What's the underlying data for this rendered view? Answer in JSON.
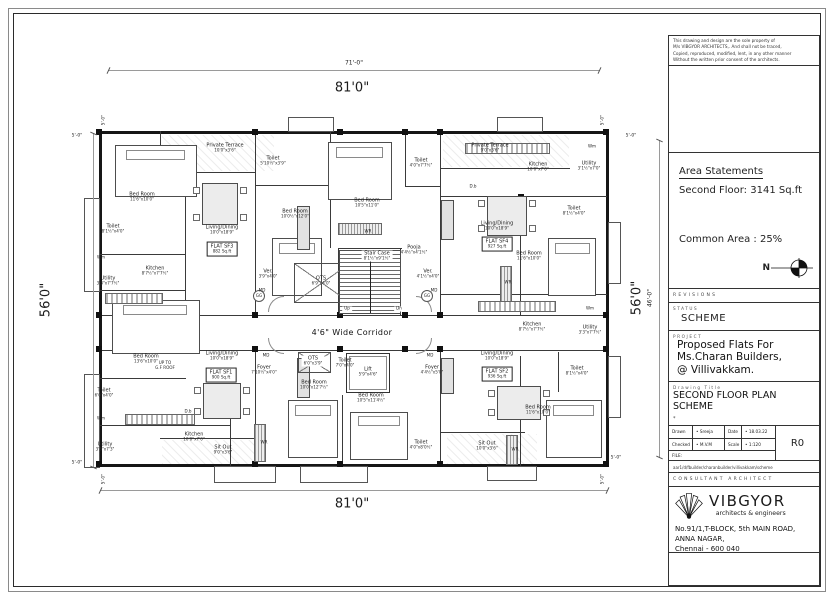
{
  "title_block": {
    "disclaimer_lines": [
      "This drawing and design are the sole property of",
      "M/s VIBGYOR ARCHITECTS,.  And shall not be traced,",
      "Copied, reproduced, modified, lent, in any other manner",
      "Without the written prior consent of the architects."
    ],
    "area_statements": {
      "heading": "Area Statements",
      "second_floor": "Second Floor: 3141 Sq.ft",
      "common_area": "Common Area : 25%",
      "north_label": "N"
    },
    "revisions_label": "REVISIONS",
    "status_label": "STATUS",
    "status_value": "SCHEME",
    "project_label": "PROJECT",
    "project_lines": [
      "Proposed Flats For",
      "Ms.Charan Builders,",
      "@ Villivakkam."
    ],
    "drawing_title_label": "Drawing Title",
    "drawing_title_lines": [
      "SECOND FLOOR PLAN",
      "SCHEME"
    ],
    "note_mark": "*",
    "table": {
      "drawn_label": "Drawn",
      "drawn_value": "Sreeja",
      "date_label": "Date",
      "date_value": "18.03.22",
      "checked_label": "Checked",
      "checked_value": "M.V.M",
      "scale_label": "Scale",
      "scale_value": "1:120",
      "revision": "R0",
      "file_label": "FILE:",
      "file_path": "aar1/d/fbuilder/charanbuilder/villivakkam/scheme"
    },
    "consultant_label": "CONSULTANT ARCHITECT",
    "firm": {
      "name": "VIBGYOR",
      "tagline": "architects & engineers",
      "address_lines": [
        "No.91/1,T-BLOCK, 5th MAIN ROAD,",
        "ANNA NAGAR,",
        "Chennai - 600 040"
      ]
    }
  },
  "plan": {
    "outer_walls": [
      [
        99,
        131,
        510,
        3
      ],
      [
        99,
        464,
        510,
        3
      ],
      [
        99,
        131,
        3,
        336
      ],
      [
        606,
        131,
        3,
        336
      ]
    ],
    "inner_walls": [
      [
        99,
        315,
        510,
        1.3
      ],
      [
        99,
        350,
        510,
        1.3
      ],
      [
        255,
        131,
        1.3,
        185
      ],
      [
        440,
        131,
        1.3,
        185
      ],
      [
        330,
        131,
        1.3,
        117
      ],
      [
        185,
        172,
        1.3,
        144
      ],
      [
        160,
        131,
        1.3,
        42
      ],
      [
        160,
        172,
        96,
        1.3
      ],
      [
        440,
        168,
        130,
        1.3
      ],
      [
        99,
        254,
        87,
        1.3
      ],
      [
        99,
        290,
        87,
        1.3
      ],
      [
        405,
        131,
        1.3,
        56
      ],
      [
        405,
        186,
        36,
        1.3
      ],
      [
        255,
        185,
        76,
        1.3
      ],
      [
        440,
        196,
        167,
        1.3
      ],
      [
        520,
        196,
        1.3,
        120
      ],
      [
        99,
        378,
        87,
        1.3
      ],
      [
        99,
        425,
        131,
        1.3
      ],
      [
        230,
        415,
        1.3,
        52
      ],
      [
        255,
        350,
        1.3,
        117
      ],
      [
        440,
        350,
        1.3,
        117
      ],
      [
        342,
        395,
        1.3,
        70
      ],
      [
        520,
        356,
        1.3,
        111
      ],
      [
        440,
        294,
        167,
        1.3
      ],
      [
        558,
        352,
        1.3,
        40
      ],
      [
        440,
        432,
        85,
        1.3
      ],
      [
        160,
        438,
        95,
        1.3
      ],
      [
        338,
        248,
        64,
        1.3
      ],
      [
        338,
        248,
        1.3,
        68
      ],
      [
        400,
        248,
        1.3,
        68
      ]
    ],
    "bumps": [
      [
        288,
        117,
        46,
        15
      ],
      [
        497,
        117,
        46,
        15
      ],
      [
        214,
        466,
        62,
        17
      ],
      [
        300,
        466,
        68,
        17
      ],
      [
        487,
        466,
        50,
        15
      ],
      [
        84,
        198,
        16,
        94
      ],
      [
        84,
        374,
        16,
        94
      ],
      [
        608,
        222,
        13,
        62
      ],
      [
        608,
        356,
        13,
        62
      ]
    ],
    "columns": [
      [
        96,
        129
      ],
      [
        252,
        129
      ],
      [
        337,
        129
      ],
      [
        402,
        129
      ],
      [
        437,
        129
      ],
      [
        603,
        129
      ],
      [
        96,
        312
      ],
      [
        252,
        312
      ],
      [
        337,
        312
      ],
      [
        402,
        312
      ],
      [
        437,
        312
      ],
      [
        603,
        312
      ],
      [
        96,
        346
      ],
      [
        252,
        346
      ],
      [
        337,
        346
      ],
      [
        402,
        346
      ],
      [
        437,
        346
      ],
      [
        603,
        346
      ],
      [
        96,
        461
      ],
      [
        252,
        461
      ],
      [
        337,
        461
      ],
      [
        437,
        461
      ],
      [
        603,
        461
      ],
      [
        182,
        170
      ],
      [
        518,
        194
      ]
    ],
    "dimlines": [
      [
        108,
        70,
        492,
        1
      ],
      [
        93,
        133,
        1,
        335
      ],
      [
        659,
        140,
        1,
        318
      ],
      [
        100,
        490,
        508,
        1
      ]
    ],
    "furniture": [
      {
        "t": "hatch",
        "x": 162,
        "y": 135,
        "w": 112,
        "h": 36
      },
      {
        "t": "hatch",
        "x": 443,
        "y": 135,
        "w": 126,
        "h": 32
      },
      {
        "t": "hatch",
        "x": 162,
        "y": 440,
        "w": 92,
        "h": 24
      },
      {
        "t": "hatch",
        "x": 447,
        "y": 434,
        "w": 90,
        "h": 30
      },
      {
        "t": "bed",
        "x": 115,
        "y": 145,
        "w": 82,
        "h": 52
      },
      {
        "t": "bed",
        "x": 328,
        "y": 142,
        "w": 64,
        "h": 58
      },
      {
        "t": "bed",
        "x": 548,
        "y": 238,
        "w": 48,
        "h": 58
      },
      {
        "t": "bed",
        "x": 112,
        "y": 300,
        "w": 88,
        "h": 54
      },
      {
        "t": "bed",
        "x": 288,
        "y": 400,
        "w": 50,
        "h": 58
      },
      {
        "t": "bed",
        "x": 350,
        "y": 412,
        "w": 58,
        "h": 48
      },
      {
        "t": "bed",
        "x": 546,
        "y": 400,
        "w": 56,
        "h": 58
      },
      {
        "t": "bed",
        "x": 272,
        "y": 238,
        "w": 50,
        "h": 58
      },
      {
        "t": "table",
        "x": 202,
        "y": 183,
        "w": 36,
        "h": 42
      },
      {
        "t": "table",
        "x": 203,
        "y": 383,
        "w": 38,
        "h": 36
      },
      {
        "t": "table",
        "x": 487,
        "y": 196,
        "w": 40,
        "h": 40
      },
      {
        "t": "table",
        "x": 497,
        "y": 386,
        "w": 44,
        "h": 34
      },
      {
        "t": "sofa",
        "x": 297,
        "y": 206,
        "w": 13,
        "h": 44
      },
      {
        "t": "sofa",
        "x": 297,
        "y": 358,
        "w": 13,
        "h": 40
      },
      {
        "t": "sofa",
        "x": 441,
        "y": 200,
        "w": 13,
        "h": 40
      },
      {
        "t": "sofa",
        "x": 441,
        "y": 358,
        "w": 13,
        "h": 36
      },
      {
        "t": "counter",
        "x": 105,
        "y": 293,
        "w": 58,
        "h": 11
      },
      {
        "t": "counter",
        "x": 125,
        "y": 414,
        "w": 70,
        "h": 11
      },
      {
        "t": "counter",
        "x": 465,
        "y": 143,
        "w": 85,
        "h": 11
      },
      {
        "t": "counter",
        "x": 478,
        "y": 301,
        "w": 78,
        "h": 11
      },
      {
        "t": "strip",
        "x": 338,
        "y": 223,
        "w": 44,
        "h": 12
      },
      {
        "t": "strip",
        "x": 254,
        "y": 424,
        "w": 12,
        "h": 38
      },
      {
        "t": "strip",
        "x": 500,
        "y": 266,
        "w": 12,
        "h": 36
      },
      {
        "t": "strip",
        "x": 506,
        "y": 435,
        "w": 12,
        "h": 30
      },
      {
        "t": "ots",
        "x": 294,
        "y": 263,
        "w": 56,
        "h": 40
      },
      {
        "t": "ots",
        "x": 298,
        "y": 352,
        "w": 33,
        "h": 21
      },
      {
        "t": "stairs",
        "x": 339,
        "y": 250,
        "w": 62,
        "h": 64
      },
      {
        "t": "shaft",
        "x": 346,
        "y": 353,
        "w": 44,
        "h": 40
      },
      {
        "t": "arc",
        "x": 268,
        "y": 296,
        "w": 16,
        "h": 16,
        "r": 0
      },
      {
        "t": "arc",
        "x": 416,
        "y": 296,
        "w": 16,
        "h": 16,
        "r": 90
      },
      {
        "t": "arc",
        "x": 268,
        "y": 338,
        "w": 16,
        "h": 16,
        "r": 270
      },
      {
        "t": "arc",
        "x": 416,
        "y": 338,
        "w": 16,
        "h": 16,
        "r": 180
      }
    ],
    "rooms": [
      {
        "l": "Bed Room",
        "s": "11'6\"x10'0\"",
        "x": 142,
        "y": 197
      },
      {
        "l": "Private Terrace",
        "s": "10'0\"x3'6\"",
        "x": 225,
        "y": 148
      },
      {
        "l": "Toilet",
        "s": "8'1½\"x4'0\"",
        "x": 113,
        "y": 229
      },
      {
        "l": "Living/Dining",
        "s": "10'0\"x18'9\"",
        "x": 222,
        "y": 230
      },
      {
        "l": "FLAT SF3",
        "s": "882 Sq.ft",
        "x": 222,
        "y": 249,
        "c": "box"
      },
      {
        "l": "Kitchen",
        "s": "8'7½\"x7'7½\"",
        "x": 155,
        "y": 271
      },
      {
        "l": "Utility",
        "s": "3'3\"x7'7½\"",
        "x": 108,
        "y": 281
      },
      {
        "l": "Wm",
        "x": 101,
        "y": 258,
        "c": "tiny"
      },
      {
        "l": "Toilet",
        "s": "5'10½\"x3'9\"",
        "x": 273,
        "y": 161
      },
      {
        "l": "Bed Room",
        "s": "10'0½\"x12'0\"",
        "x": 295,
        "y": 214
      },
      {
        "l": "Bed Room",
        "s": "10'5\"x11'0\"",
        "x": 367,
        "y": 203
      },
      {
        "l": "Toilet",
        "s": "4'0\"x7'7½\"",
        "x": 421,
        "y": 163
      },
      {
        "l": "WR",
        "x": 368,
        "y": 232,
        "c": "tiny"
      },
      {
        "l": "Stair Case",
        "s": "8'1½\"x9'1½\"",
        "x": 377,
        "y": 256,
        "c": "onwhite"
      },
      {
        "l": "Pooja",
        "s": "4'4½\"x4'1½\"",
        "x": 414,
        "y": 250
      },
      {
        "l": "Ver.",
        "s": "3'9\"x4'0\"",
        "x": 268,
        "y": 274
      },
      {
        "l": "OTS",
        "s": "6'9\"x4'0\"",
        "x": 321,
        "y": 281
      },
      {
        "l": "Ver.",
        "s": "4'1½\"x4'0\"",
        "x": 428,
        "y": 274
      },
      {
        "l": "GG",
        "x": 259,
        "y": 296,
        "c": "circle"
      },
      {
        "l": "GG",
        "x": 427,
        "y": 296,
        "c": "circle"
      },
      {
        "l": "Up",
        "x": 347,
        "y": 309,
        "c": "tiny onwhite"
      },
      {
        "l": "Dn",
        "x": 399,
        "y": 309,
        "c": "tiny onwhite"
      },
      {
        "l": "4'6\" Wide Corridor",
        "x": 352,
        "y": 333,
        "c": "corridor"
      },
      {
        "l": "MD",
        "x": 262,
        "y": 291,
        "c": "tiny"
      },
      {
        "l": "MD",
        "x": 434,
        "y": 291,
        "c": "tiny"
      },
      {
        "l": "MD",
        "x": 266,
        "y": 356,
        "c": "tiny"
      },
      {
        "l": "MD",
        "x": 430,
        "y": 356,
        "c": "tiny"
      },
      {
        "l": "OTS",
        "s": "6'0\"x3'9\"",
        "x": 313,
        "y": 361,
        "c": "onwhite"
      },
      {
        "l": "Toilet",
        "s": "7'0\"x4'0\"",
        "x": 345,
        "y": 363
      },
      {
        "l": "Lift",
        "s": "5'9\"x4'6\"",
        "x": 368,
        "y": 372,
        "c": "onwhite"
      },
      {
        "l": "Foyer",
        "s": "7'10½\"x4'0\"",
        "x": 264,
        "y": 370
      },
      {
        "l": "Foyer",
        "s": "4'4½\"x5'0\"",
        "x": 432,
        "y": 370
      },
      {
        "l": "Bed Room",
        "s": "13'6\"x10'0\"",
        "x": 146,
        "y": 359
      },
      {
        "l": "UP TO",
        "s": "G.F ROOF",
        "x": 165,
        "y": 366,
        "c": "tiny"
      },
      {
        "l": "Living/Dining",
        "s": "10'0\"x18'9\"",
        "x": 222,
        "y": 356
      },
      {
        "l": "FLAT SF1",
        "s": "900 Sq.ft",
        "x": 221,
        "y": 375,
        "c": "box"
      },
      {
        "l": "Toilet",
        "s": "6'0\"x4'0\"",
        "x": 104,
        "y": 393
      },
      {
        "l": "Wm",
        "x": 101,
        "y": 419,
        "c": "tiny"
      },
      {
        "l": "Utility",
        "s": "3'3\"x7'3\"",
        "x": 105,
        "y": 447
      },
      {
        "l": "Kitchen",
        "s": "10'0\"x7'0\"",
        "x": 194,
        "y": 437
      },
      {
        "l": "D.b",
        "x": 188,
        "y": 412,
        "c": "tiny"
      },
      {
        "l": "Sit Out",
        "s": "9'0\"x3'6\"",
        "x": 223,
        "y": 450
      },
      {
        "l": "WR",
        "x": 264,
        "y": 443,
        "c": "tiny"
      },
      {
        "l": "Bed Room",
        "s": "10'0\"x12'7½\"",
        "x": 314,
        "y": 385
      },
      {
        "l": "Bed Room",
        "s": "10'5\"x11'4½\"",
        "x": 371,
        "y": 398
      },
      {
        "l": "Toilet",
        "s": "4'0\"x8'0½\"",
        "x": 421,
        "y": 445
      },
      {
        "l": "Private Terrace",
        "s": "9'0\"x3'6\"",
        "x": 490,
        "y": 148
      },
      {
        "l": "Kitchen",
        "s": "10'0\"x7'0\"",
        "x": 538,
        "y": 167
      },
      {
        "l": "Utility",
        "s": "3'1½\"x7'0\"",
        "x": 589,
        "y": 166
      },
      {
        "l": "Wm",
        "x": 592,
        "y": 147,
        "c": "tiny"
      },
      {
        "l": "D.b",
        "x": 473,
        "y": 187,
        "c": "tiny"
      },
      {
        "l": "Toilet",
        "s": "8'1½\"x4'0\"",
        "x": 574,
        "y": 211
      },
      {
        "l": "Living/Dining",
        "s": "10'0\"x18'9\"",
        "x": 497,
        "y": 226
      },
      {
        "l": "FLAT SF4",
        "s": "927 Sq.ft",
        "x": 497,
        "y": 244,
        "c": "box"
      },
      {
        "l": "Bed Room",
        "s": "11'6\"x10'0\"",
        "x": 529,
        "y": 256
      },
      {
        "l": "WR",
        "x": 508,
        "y": 283,
        "c": "tiny"
      },
      {
        "l": "Kitchen",
        "s": "8'7½\"x7'7½\"",
        "x": 532,
        "y": 327
      },
      {
        "l": "Utility",
        "s": "3'3\"x7'7½\"",
        "x": 590,
        "y": 330
      },
      {
        "l": "Wm",
        "x": 590,
        "y": 309,
        "c": "tiny"
      },
      {
        "l": "Living/Dining",
        "s": "10'0\"x18'9\"",
        "x": 497,
        "y": 356
      },
      {
        "l": "FLAT SF2",
        "s": "936 Sq.ft",
        "x": 497,
        "y": 374,
        "c": "box"
      },
      {
        "l": "Toilet",
        "s": "8'1½\"x4'0\"",
        "x": 577,
        "y": 371
      },
      {
        "l": "Bed Room",
        "s": "11'6\"x10'0\"",
        "x": 538,
        "y": 410
      },
      {
        "l": "WR",
        "x": 515,
        "y": 450,
        "c": "tiny"
      },
      {
        "l": "Sit Out",
        "s": "10'0\"x3'6\"",
        "x": 487,
        "y": 446
      }
    ],
    "dims": [
      {
        "t": "71'-0\"",
        "x": 354,
        "y": 63,
        "f": 6
      },
      {
        "t": "81'0\"",
        "x": 352,
        "y": 88,
        "f": 13
      },
      {
        "t": "81'0\"",
        "x": 352,
        "y": 504,
        "f": 13
      },
      {
        "t": "56'0\"",
        "x": 46,
        "y": 300,
        "f": 13,
        "r": -90
      },
      {
        "t": "56'0\"",
        "x": 637,
        "y": 298,
        "f": 13,
        "r": -90
      },
      {
        "t": "46'-0\"",
        "x": 650,
        "y": 298,
        "f": 6,
        "r": -90
      },
      {
        "t": "5'-0\"",
        "x": 104,
        "y": 120,
        "f": 4.5,
        "r": -90
      },
      {
        "t": "5'-0\"",
        "x": 603,
        "y": 120,
        "f": 4.5,
        "r": -90
      },
      {
        "t": "5'-0\"",
        "x": 77,
        "y": 136,
        "f": 4.5
      },
      {
        "t": "5'-0\"",
        "x": 631,
        "y": 136,
        "f": 4.5
      },
      {
        "t": "5'-0\"",
        "x": 104,
        "y": 479,
        "f": 4.5,
        "r": -90
      },
      {
        "t": "5'-0\"",
        "x": 603,
        "y": 479,
        "f": 4.5,
        "r": -90
      },
      {
        "t": "5'-0\"",
        "x": 77,
        "y": 463,
        "f": 4.5
      },
      {
        "t": "5'-0\"",
        "x": 616,
        "y": 458,
        "f": 4.5
      }
    ]
  }
}
